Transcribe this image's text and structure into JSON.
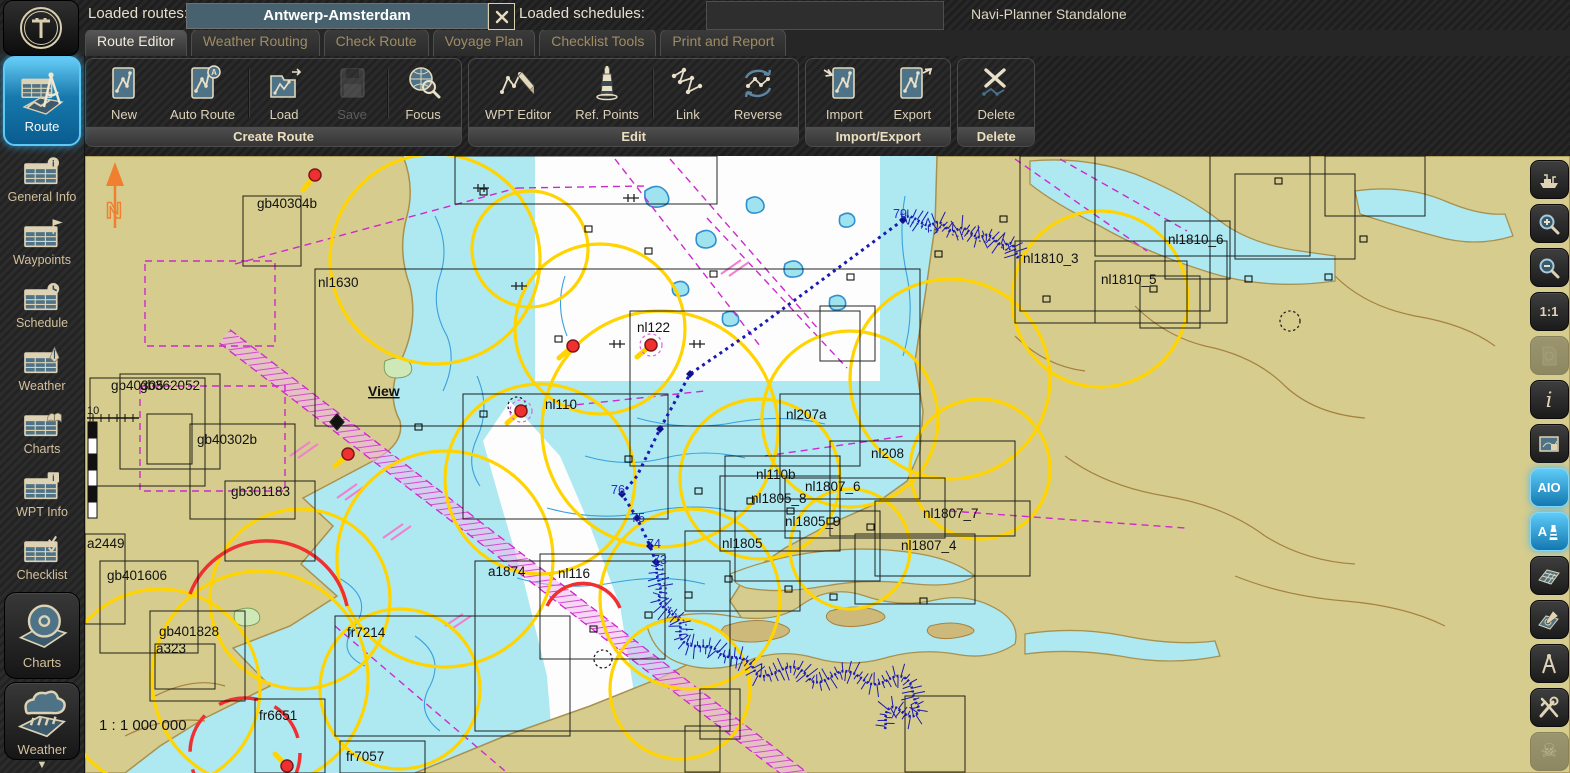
{
  "window": {
    "title": "Navi-Planner Standalone",
    "logo_letter": "T"
  },
  "topbar": {
    "loaded_routes_label": "Loaded routes:",
    "route_value": "Antwerp-Amsterdam",
    "loaded_schedules_label": "Loaded schedules:",
    "schedules_value": ""
  },
  "icons": {
    "clear_route": "X",
    "scroll_down": "▼",
    "skull": "☠"
  },
  "tabs": [
    {
      "label": "Route Editor",
      "active": true
    },
    {
      "label": "Weather Routing",
      "active": false
    },
    {
      "label": "Check Route",
      "active": false
    },
    {
      "label": "Voyage Plan",
      "active": false
    },
    {
      "label": "Checklist Tools",
      "active": false
    },
    {
      "label": "Print and Report",
      "active": false
    }
  ],
  "toolbar": {
    "groups": [
      {
        "label": "Create Route",
        "buttons": [
          {
            "label": "New"
          },
          {
            "label": "Auto Route"
          },
          {
            "label": "Load"
          },
          {
            "label": "Save",
            "disabled": true
          },
          {
            "label": "Focus"
          }
        ]
      },
      {
        "label": "Edit",
        "buttons": [
          {
            "label": "WPT Editor"
          },
          {
            "label": "Ref. Points"
          },
          {
            "label": "Link"
          },
          {
            "label": "Reverse"
          }
        ]
      },
      {
        "label": "Import/Export",
        "buttons": [
          {
            "label": "Import"
          },
          {
            "label": "Export"
          }
        ]
      },
      {
        "label": "Delete",
        "buttons": [
          {
            "label": "Delete"
          }
        ]
      }
    ]
  },
  "sidebar_left": {
    "items": [
      {
        "label": "Route",
        "active": true
      },
      {
        "label": "General Info"
      },
      {
        "label": "Waypoints"
      },
      {
        "label": "Schedule"
      },
      {
        "label": "Weather"
      },
      {
        "label": "Charts"
      },
      {
        "label": "WPT Info"
      },
      {
        "label": "Checklist"
      }
    ],
    "library": [
      {
        "label": "Charts"
      },
      {
        "label": "Weather"
      }
    ]
  },
  "sidebar_right": {
    "scale_label": "1:1",
    "info_label": "i",
    "aio_label": "AIO",
    "aio_lights_label": "A"
  },
  "map": {
    "north_label": "N",
    "view_label": "View",
    "scale_text": "1 : 1 000 000",
    "mini_scale": "10",
    "chart_labels": [
      "gb40304b",
      "nl1630",
      "nl122",
      "nl110",
      "nl207a",
      "nl208",
      "nl110b",
      "nl1805_8",
      "nl1807_6",
      "nl1807_7",
      "nl1805_9",
      "nl1805",
      "nl1807_4",
      "nl1810_3",
      "nl1810_5",
      "nl1810_6",
      "nl116",
      "a1874",
      "fr7214",
      "fr6651",
      "fr7057",
      "gb40302b",
      "gb301183",
      "gb40305",
      "gb362052",
      "a2449",
      "gb401606",
      "gb401828",
      "a323"
    ],
    "route_waypoint_labels": [
      "79",
      "76",
      "75",
      "74",
      "73"
    ],
    "colors": {
      "land": "#d6cc8e",
      "shallow_water": "#aee9f2",
      "deep_water": "#fdfdfd",
      "contour_blue": "#2f8fd0",
      "light_sector_yellow": "#ffd400",
      "caution_magenta": "#cc2acc",
      "route_blue": "#1a1ab2",
      "danger_red": "#f03030"
    }
  }
}
